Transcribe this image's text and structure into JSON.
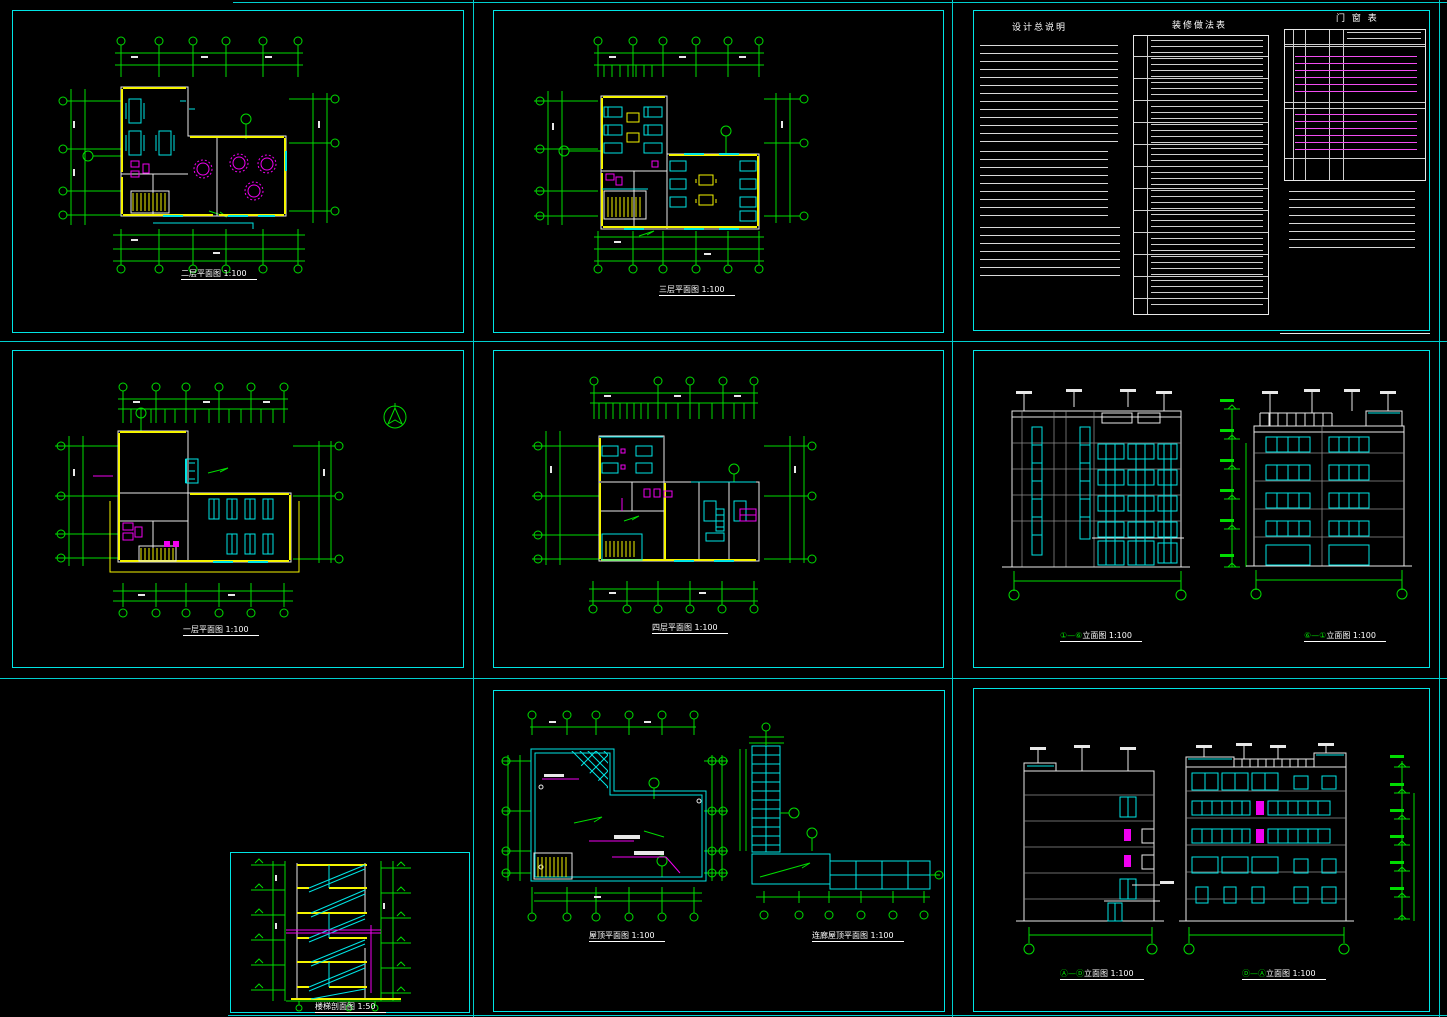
{
  "canvas": {
    "width": 1447,
    "height": 1017,
    "background": "#000000"
  },
  "palette": {
    "sheet_border": "#00e5e5",
    "axis_dimension": "#00dc00",
    "wall_highlight": "#f5f500",
    "fixture": "#00e5e5",
    "outline": "#e8e8e8",
    "accent": "#f000f0"
  },
  "sheets": {
    "plan_2f": {
      "title": "二层平面图 1:100"
    },
    "plan_3f": {
      "title": "三层平面图 1:100"
    },
    "notes": {
      "general_title": "设计总说明",
      "finish_title": "装修做法表",
      "door_window_title": "门 窗 表"
    },
    "plan_1f": {
      "title": "一层平面图 1:100"
    },
    "plan_4f": {
      "title": "四层平面图 1:100"
    },
    "elev_1_6": {
      "titles": [
        {
          "axes": "①—⑥",
          "label": "立面图 1:100"
        },
        {
          "axes": "⑥—①",
          "label": "立面图 1:100"
        }
      ]
    },
    "stair_section": {
      "title": "楼梯剖面图 1:50"
    },
    "roof": {
      "titles": [
        {
          "axes": "",
          "label": "屋顶平面图 1:100"
        },
        {
          "axes": "",
          "label": "连廊屋顶平面图 1:100"
        }
      ]
    },
    "elev_a_d": {
      "titles": [
        {
          "axes": "Ⓐ—Ⓓ",
          "label": "立面图 1:100"
        },
        {
          "axes": "Ⓓ—Ⓐ",
          "label": "立面图 1:100"
        }
      ]
    }
  }
}
